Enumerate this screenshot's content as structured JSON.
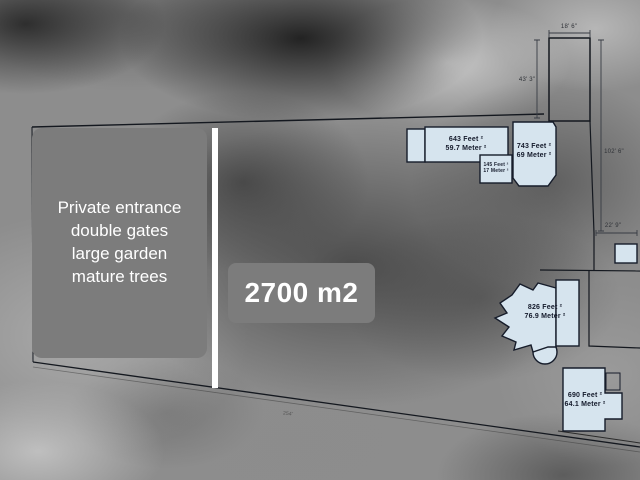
{
  "plan": {
    "area_label": "2700 m2",
    "features": [
      "Private entrance",
      "double gates",
      "large garden",
      "mature trees"
    ],
    "buildings": {
      "b643": {
        "feet": "643 Feet ²",
        "meter": "59.7 Meter ²"
      },
      "b145": {
        "feet": "145 Feet ²",
        "meter": "17 Meter ²"
      },
      "b743": {
        "feet": "743 Feet ²",
        "meter": "69 Meter ²"
      },
      "b826": {
        "feet": "826 Feet ²",
        "meter": "76.9 Meter ²"
      },
      "b690": {
        "feet": "690 Feet ²",
        "meter": "64.1 Meter ²"
      }
    },
    "dimensions": {
      "top": "18' 6\"",
      "left": "43' 3\"",
      "right": "102' 6\"",
      "corner": "22' 9\"",
      "bottom": "254'"
    },
    "colors": {
      "building_fill": "#d6e4ee",
      "plan_line": "#161c2a",
      "overlay_gray": "#7c7c7c",
      "overlay_text": "#ffffff"
    }
  }
}
